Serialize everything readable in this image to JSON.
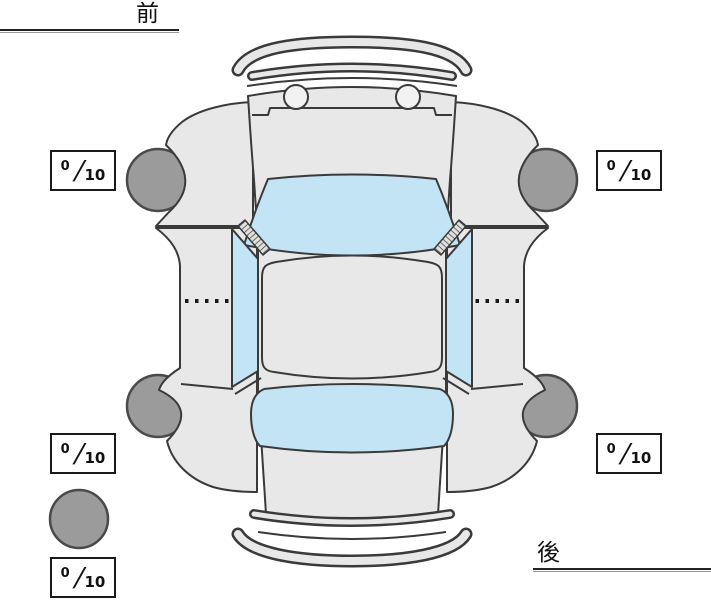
{
  "labels": {
    "front": "前",
    "rear": "後"
  },
  "separator": "/",
  "tread": {
    "front_left": {
      "value": "0",
      "max": "10"
    },
    "front_right": {
      "value": "0",
      "max": "10"
    },
    "rear_left": {
      "value": "0",
      "max": "10"
    },
    "rear_right": {
      "value": "0",
      "max": "10"
    },
    "spare": {
      "value": "0",
      "max": "10"
    }
  },
  "colors": {
    "background": "#ffffff",
    "body": "#e8e8e8",
    "outline": "#3a3a3a",
    "glass": "#c2e4f5",
    "tire": "#9b9b9b",
    "tire_outline": "#4a4a4a",
    "headlight": "#f2f2f2",
    "line": "#1a1a1a",
    "box_border": "#1a1a1a"
  }
}
